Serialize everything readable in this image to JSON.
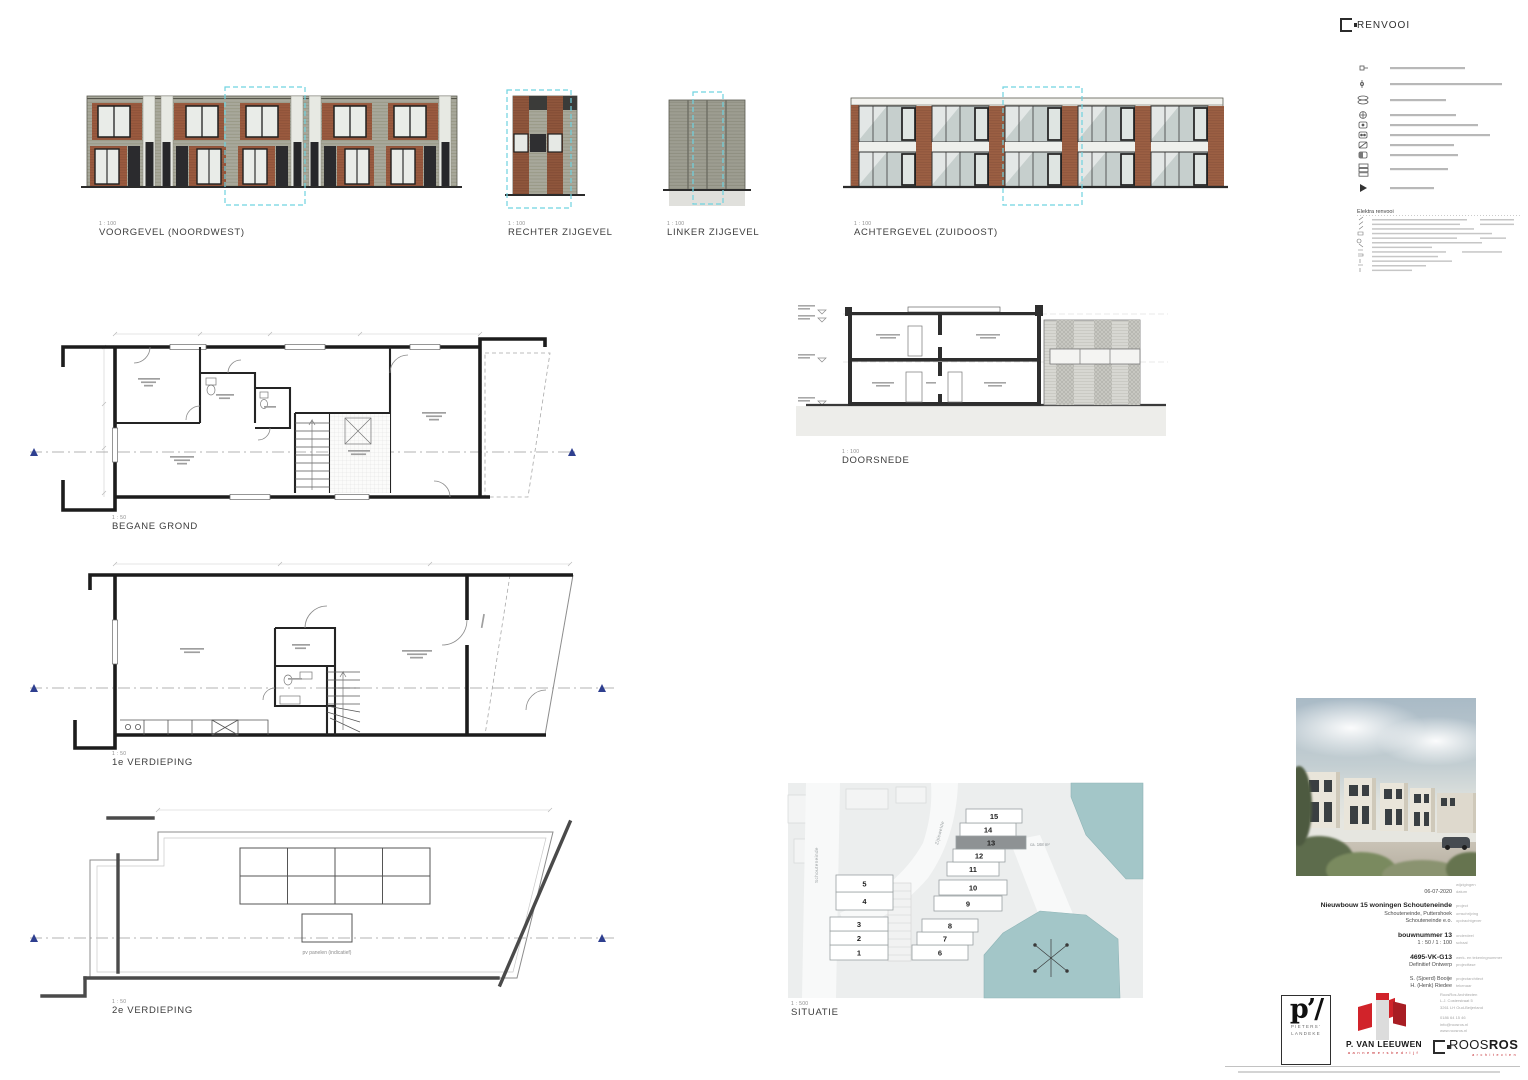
{
  "renvooi": {
    "title": "RENVOOI",
    "elektra_title": "Elektra  renvooi"
  },
  "views": {
    "voorgevel": {
      "scale": "1 : 100",
      "label": "VOORGEVEL (NOORDWEST)"
    },
    "rechter": {
      "scale": "1 : 100",
      "label": "RECHTER ZIJGEVEL"
    },
    "linker": {
      "scale": "1 : 100",
      "label": "LINKER ZIJGEVEL"
    },
    "achtergevel": {
      "scale": "1 : 100",
      "label": "ACHTERGEVEL (ZUIDOOST)"
    },
    "doorsnede": {
      "scale": "1 : 100",
      "label": "DOORSNEDE"
    },
    "begane_grond": {
      "scale": "1 : 50",
      "label": "BEGANE GROND"
    },
    "verdieping1": {
      "scale": "1 : 50",
      "label": "1e VERDIEPING"
    },
    "verdieping2": {
      "scale": "1 : 50",
      "label": "2e VERDIEPING"
    },
    "situatie": {
      "scale": "1 : 500",
      "label": "SITUATIE"
    }
  },
  "roof": {
    "pv_label": "pv panelen (indicatief)"
  },
  "situatie": {
    "plots": [
      "1",
      "2",
      "3",
      "4",
      "5",
      "6",
      "7",
      "8",
      "9",
      "10",
      "11",
      "12",
      "13",
      "14",
      "15"
    ],
    "highlighted_plot": "13",
    "area_label": "ca. 168 m²",
    "street_left": "Schouteneinde",
    "street_mid": "Zijleweide"
  },
  "titleblock": {
    "rev_label": "wijzigingen",
    "date": "06-07-2020",
    "date_label": "datum",
    "project": "Nieuwbouw 15 woningen Schouteneinde",
    "project_label": "project",
    "location": "Schouteneinde, Puttershoek",
    "location_label": "omschrijving",
    "client": "Schouteneinde e.o.",
    "client_label": "opdrachtgever",
    "part": "bouwnummer 13",
    "part_label": "onderdeel",
    "scale": "1 : 50 / 1 : 100",
    "scale_label": "schaal",
    "drawing_no": "4695-VK-G13",
    "drawing_no_label": "werk- en tekeningnummer",
    "phase": "Definitief Ontwerp",
    "phase_label": "projectfase",
    "architect": "S. (Sjoerd) Booije",
    "architect_label": "projectarchitect",
    "drafter": "H. (Henk) Riedee",
    "drafter_label": "tekenaar"
  },
  "logos": {
    "pieters": {
      "mark": "p’/",
      "line1": "PIETERS’",
      "line2": "LANDEKE"
    },
    "vanleeuwen": {
      "name": "P. VAN LEEUWEN",
      "sub": "aannemersbedrijf"
    },
    "roosros": {
      "name_light": "ROOS",
      "name_bold": "ROS",
      "sub": "architecten",
      "address1": "RoosRos Architecten",
      "address2": "L.J. Costerstraat 5",
      "address3": "3261 LH Oud-Beijerland",
      "address4": "0186 64 15 46",
      "address5": "info@roosros.nl",
      "address6": "www.roosros.nl"
    }
  },
  "colors": {
    "cyan_marker": "#6fd3e0",
    "brick": "#9a5a3f",
    "siding": "#a8a89b",
    "water": "#a3c6c8",
    "plot_highlight": "#8e9294",
    "logo_red": "#c22127",
    "marker_navy": "#2e3f8f"
  }
}
